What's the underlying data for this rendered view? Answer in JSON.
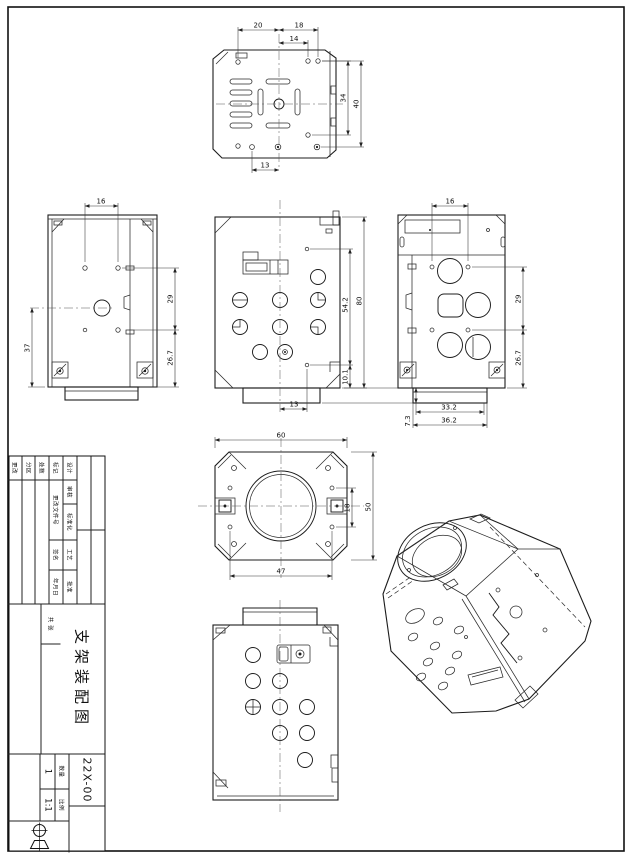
{
  "sheet": {
    "background": "#ffffff",
    "line_color": "#1c1c1c"
  },
  "dims": {
    "top": {
      "w1": "20",
      "w2": "18",
      "w3": "14",
      "h1": "34",
      "h2": "40",
      "b1": "13"
    },
    "left": {
      "t": "16",
      "l": "37",
      "r1": "29",
      "r2": "26.7"
    },
    "front": {
      "r1": "54.2",
      "r2": "80",
      "r3": "10.1",
      "b1": "13",
      "b2": "7.3"
    },
    "right": {
      "t": "16",
      "r1": "29",
      "r2": "26.7",
      "b1": "33.2",
      "b2": "36.2"
    },
    "face": {
      "t": "60",
      "r1": "50",
      "r2": "18",
      "b1": "47"
    }
  },
  "titleblock": {
    "title": "支架装配图",
    "drawing_no": "22X-00",
    "qty_label": "数量",
    "qty_value": "1",
    "scale_label": "比例",
    "scale_value": "1:1",
    "sheet_label": "共 张",
    "row_labels": [
      "设计",
      "审核",
      "标准化",
      "工艺",
      "批准"
    ],
    "rev_labels": [
      "标记",
      "处数",
      "分区",
      "更改"
    ],
    "rev_sub": [
      "签名",
      "日期"
    ],
    "change_label": "更改文件号",
    "sign_label": "签名",
    "date_label": "年月日"
  }
}
